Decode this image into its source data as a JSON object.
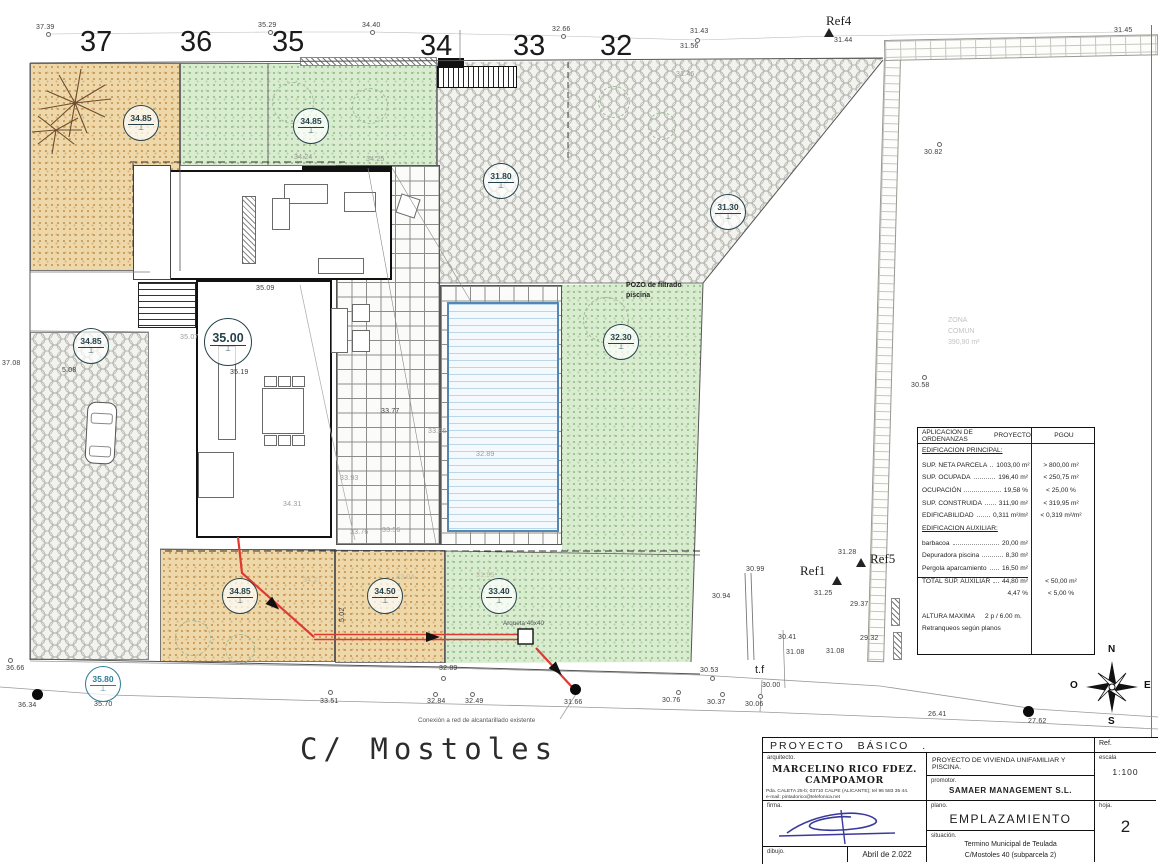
{
  "plot_numbers": {
    "p37": "37",
    "p36": "36",
    "p35": "35",
    "p34": "34",
    "p33": "33",
    "p32": "32"
  },
  "refs": {
    "ref4": "Ref4",
    "ref1": "Ref1",
    "ref5": "Ref5"
  },
  "elevations": {
    "c1": "34.85",
    "c2": "34.85",
    "c3": "31.80",
    "c4": "31.30",
    "c5": "34.85",
    "c6": "35.00",
    "c7": "32.30",
    "c8": "34.85",
    "c9": "34.50",
    "c10": "33.40",
    "c11": "35.80"
  },
  "spots": {
    "s1": "37.39",
    "s2": "35.29",
    "s3": "34.40",
    "s4": "32.66",
    "s5": "31.43",
    "s6": "31.56",
    "s7": "31.44",
    "s8": "31.45",
    "s9": "31.46",
    "s10": "30.82",
    "s11": "30.58",
    "s12": "37.08",
    "s13": "35.07",
    "s14": "35.09",
    "s15": "35.19",
    "s16": "34.24",
    "s17": "34.25",
    "s18": "33.77",
    "s19": "33.86",
    "s20": "33.93",
    "s21": "34.31",
    "s22": "33.76",
    "s23": "33.56",
    "s24": "32.89",
    "s25": "32.89",
    "s26": "33.51",
    "s27": "32.84",
    "s28": "32.49",
    "s29": "31.66",
    "s30": "30.76",
    "s31": "30.37",
    "s32": "30.06",
    "s33": "30.53",
    "s34": "30.00",
    "s35": "30.41",
    "s36": "31.08",
    "s37": "31.08",
    "s38": "29.32",
    "s39": "26.41",
    "s40": "27.62",
    "s41": "36.66",
    "s42": "36.34",
    "s43": "35.70",
    "s44": "30.99",
    "s45": "30.94",
    "s46": "31.28",
    "s47": "31.25",
    "s48": "29.37",
    "s49": "5.02",
    "s50": "5.08",
    "s51": "34.27",
    "s52": "33.04",
    "s53": "31.95"
  },
  "labels": {
    "street_name": "C/ Mostoles",
    "sewer_note": "Conexión a red de alcantarillado existente",
    "arqueta": "Arqueta 40x40",
    "pozo1": "POZO de filtrado",
    "pozo2": "piscina",
    "tf": "t.f",
    "zona1": "ZONA",
    "zona2": "COMUN",
    "zona3": "390,90 m²"
  },
  "compass": {
    "n": "N",
    "s": "S",
    "e": "E",
    "o": "O"
  },
  "ordenanzas": {
    "header": {
      "left": "APLICACION DE ORDENANZAS",
      "proyecto": "PROYECTO",
      "pgou": "PGOU"
    },
    "section1": "EDIFICACION PRINCIPAL:",
    "rows1": [
      {
        "label": "SUP. NETA PARCELA",
        "proyecto": "1003,00 m²",
        "pgou": "> 800,00 m²"
      },
      {
        "label": "SUP. OCUPADA",
        "proyecto": "196,40 m²",
        "pgou": "< 250,75 m²"
      },
      {
        "label": "OCUPACIÓN",
        "proyecto": "19,58 %",
        "pgou": "< 25,00 %"
      },
      {
        "label": "SUP. CONSTRUIDA",
        "proyecto": "311,90 m²",
        "pgou": "< 319,95 m²"
      },
      {
        "label": "EDIFICABILIDAD",
        "proyecto": "0,311 m²/m²",
        "pgou": "< 0,319 m²/m²"
      }
    ],
    "section2": "EDIFICACION AUXILIAR:",
    "rows2": [
      {
        "label": "barbacoa",
        "proyecto": "20,00 m²",
        "pgou": ""
      },
      {
        "label": "Depuradora piscina",
        "proyecto": "8,30 m²",
        "pgou": ""
      },
      {
        "label": "Pergola aparcamiento",
        "proyecto": "16,50 m²",
        "pgou": ""
      },
      {
        "label": "TOTAL SUP. AUXILIAR",
        "proyecto": "44,80 m²",
        "pgou": "< 50,00 m²"
      },
      {
        "label": "",
        "proyecto": "4,47 %",
        "pgou": "< 5,00 %"
      }
    ],
    "altura_label": "ALTURA MAXIMA",
    "altura_value": "2 p / 6.00 m.",
    "retranqueos": "Retranqueos según planos"
  },
  "titleblock": {
    "header": "PROYECTO BÁSICO .",
    "ref_label": "Ref.",
    "arquitecto_label": "arquitecto.",
    "arquitecto_name": "MARCELINO RICO FDEZ. CAMPOAMOR",
    "address1": "Pda. CALETA 25-b; 03710 CALPE (ALICANTE); tel 96 583 35 44.",
    "address2": "e-mail: pintadorico@telefonica.net",
    "firma_label": "firma.",
    "dibujo_label": "dibujo.",
    "fecha": "Abril de 2.022",
    "proyecto_desc": "PROYECTO DE VIVIENDA UNIFAMILIAR Y PISCINA.",
    "promotor_label": "promotor.",
    "promotor": "SAMAER MANAGEMENT S.L.",
    "plano_label": "plano.",
    "plano": "EMPLAZAMIENTO",
    "situacion_label": "situación.",
    "situacion1": "Termino Municipal de Teulada",
    "situacion2": "C/Mostoles 40 (subparcela 2)",
    "escala_label": "escala",
    "escala": "1:100",
    "hoja_label": "hoja.",
    "hoja": "2"
  }
}
